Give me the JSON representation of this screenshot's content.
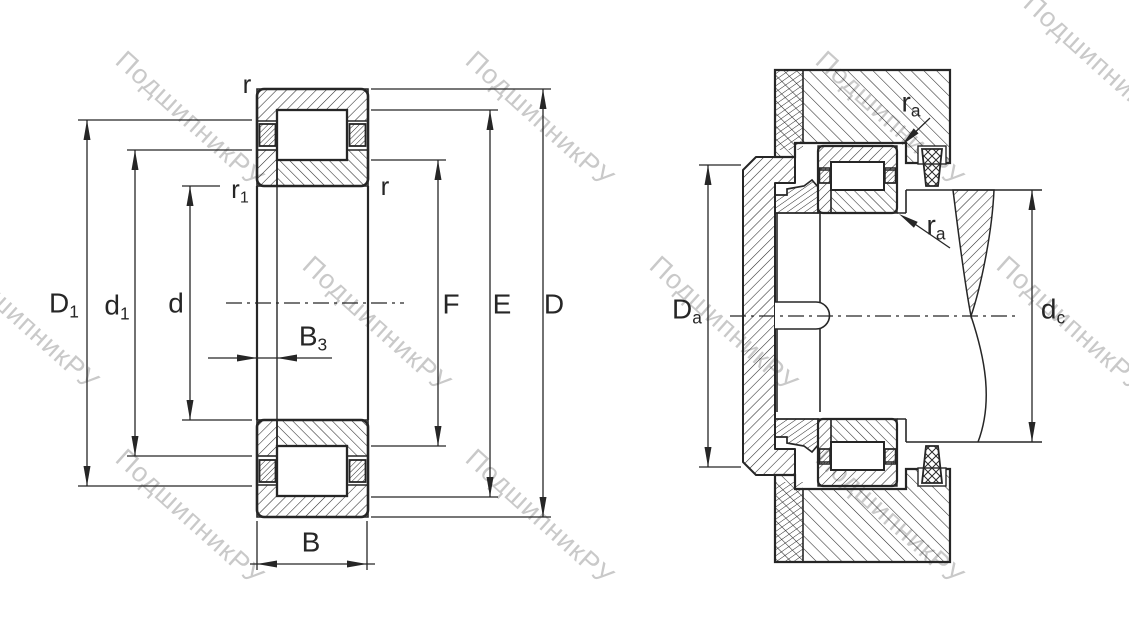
{
  "diagram": {
    "type": "technical-drawing",
    "subject": "cylindrical-roller-bearing-cross-section-and-mounting",
    "background_color": "#ffffff",
    "line_color": "#262626",
    "watermark": {
      "text": "ПодшипникРУ",
      "color": "#c9c9c9",
      "angle_deg": 42
    },
    "left_view": {
      "name": "bearing-dimensions-view",
      "labels": {
        "r_top": {
          "base": "r",
          "sub": ""
        },
        "r1": {
          "base": "r",
          "sub": "1"
        },
        "r_right": {
          "base": "r",
          "sub": ""
        },
        "D1": {
          "base": "D",
          "sub": "1"
        },
        "d1": {
          "base": "d",
          "sub": "1"
        },
        "d": {
          "base": "d",
          "sub": ""
        },
        "B3": {
          "base": "B",
          "sub": "3"
        },
        "B": {
          "base": "B",
          "sub": ""
        },
        "F": {
          "base": "F",
          "sub": ""
        },
        "E": {
          "base": "E",
          "sub": ""
        },
        "D": {
          "base": "D",
          "sub": ""
        }
      }
    },
    "right_view": {
      "name": "bearing-mounting-view",
      "labels": {
        "ra_top": {
          "base": "r",
          "sub": "a"
        },
        "ra_bottom": {
          "base": "r",
          "sub": "a"
        },
        "Da": {
          "base": "D",
          "sub": "a"
        },
        "dc": {
          "base": "d",
          "sub": "c"
        }
      }
    }
  }
}
